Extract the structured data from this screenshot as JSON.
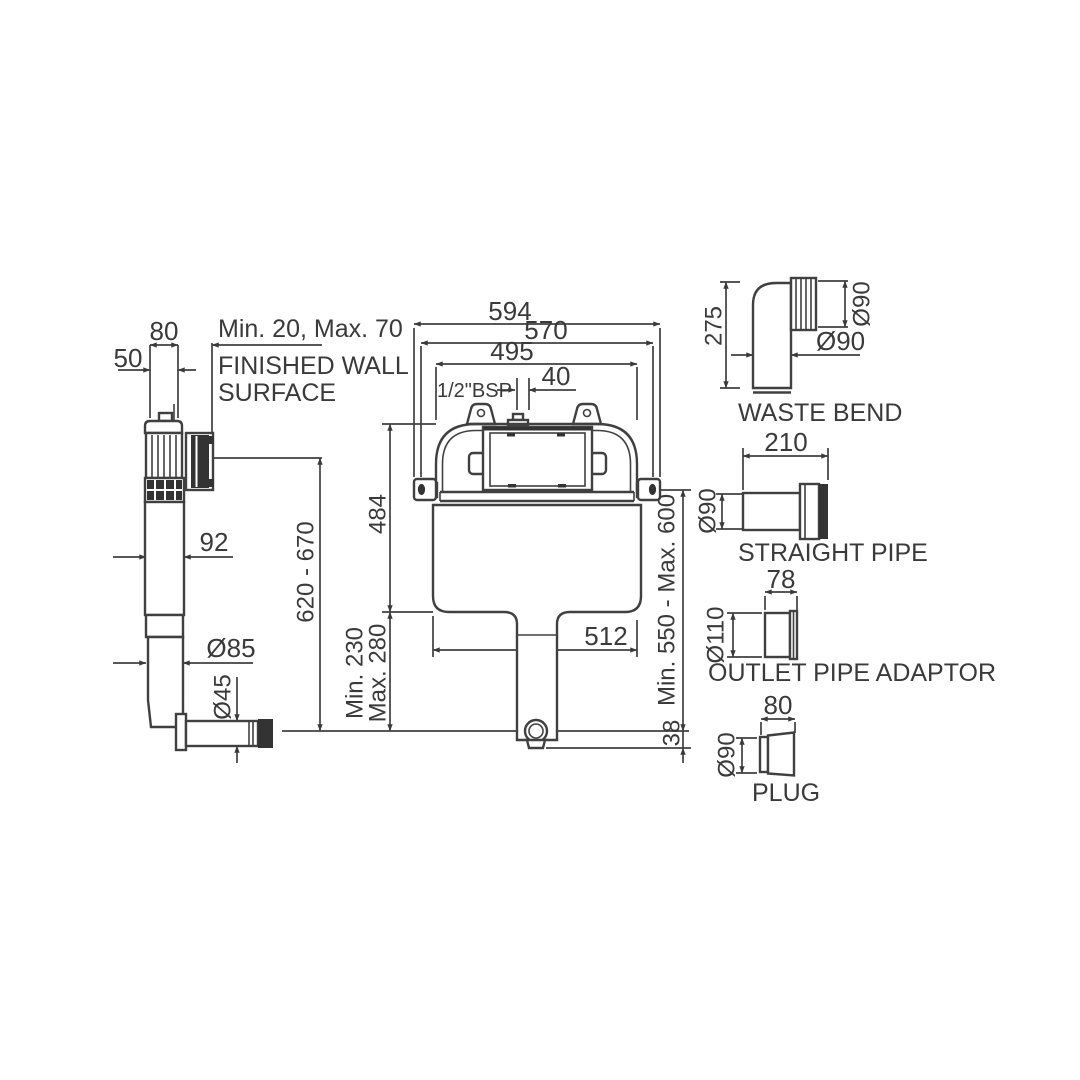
{
  "page": {
    "background": "#ffffff",
    "line_color": "#404040"
  },
  "side_view": {
    "dim_depth_80": "80",
    "dim_50": "50",
    "dim_wall_offset": "Min. 20, Max. 70",
    "wall_label_line1": "FINISHED WALL",
    "wall_label_line2": "SURFACE",
    "dim_body_92": "92",
    "dim_height_range": "620 - 670",
    "dim_pipe_d85": "Ø85",
    "dim_outlet_d45": "Ø45"
  },
  "front_view": {
    "dim_overall_594": "594",
    "dim_bolts_570": "570",
    "dim_frame_495": "495",
    "inlet_label": "1/2\"BSP",
    "dim_inlet_offset_40": "40",
    "dim_frame_height_484": "484",
    "dim_depth_min": "Min. 230",
    "dim_depth_max": "Max. 280",
    "dim_tank_512": "512",
    "dim_install_height": "Min. 550 - Max. 600",
    "dim_outlet_height_38": "38"
  },
  "accessories": {
    "waste_bend": {
      "label": "WASTE BEND",
      "dim_height": "275",
      "dim_socket_dia": "Ø90",
      "dim_pipe_dia": "Ø90"
    },
    "straight_pipe": {
      "label": "STRAIGHT PIPE",
      "dim_length": "210",
      "dim_dia": "Ø90"
    },
    "outlet_pipe_adaptor": {
      "label": "OUTLET PIPE ADAPTOR",
      "dim_length": "78",
      "dim_dia": "Ø110"
    },
    "plug": {
      "label": "PLUG",
      "dim_length": "80",
      "dim_dia": "Ø90"
    }
  }
}
